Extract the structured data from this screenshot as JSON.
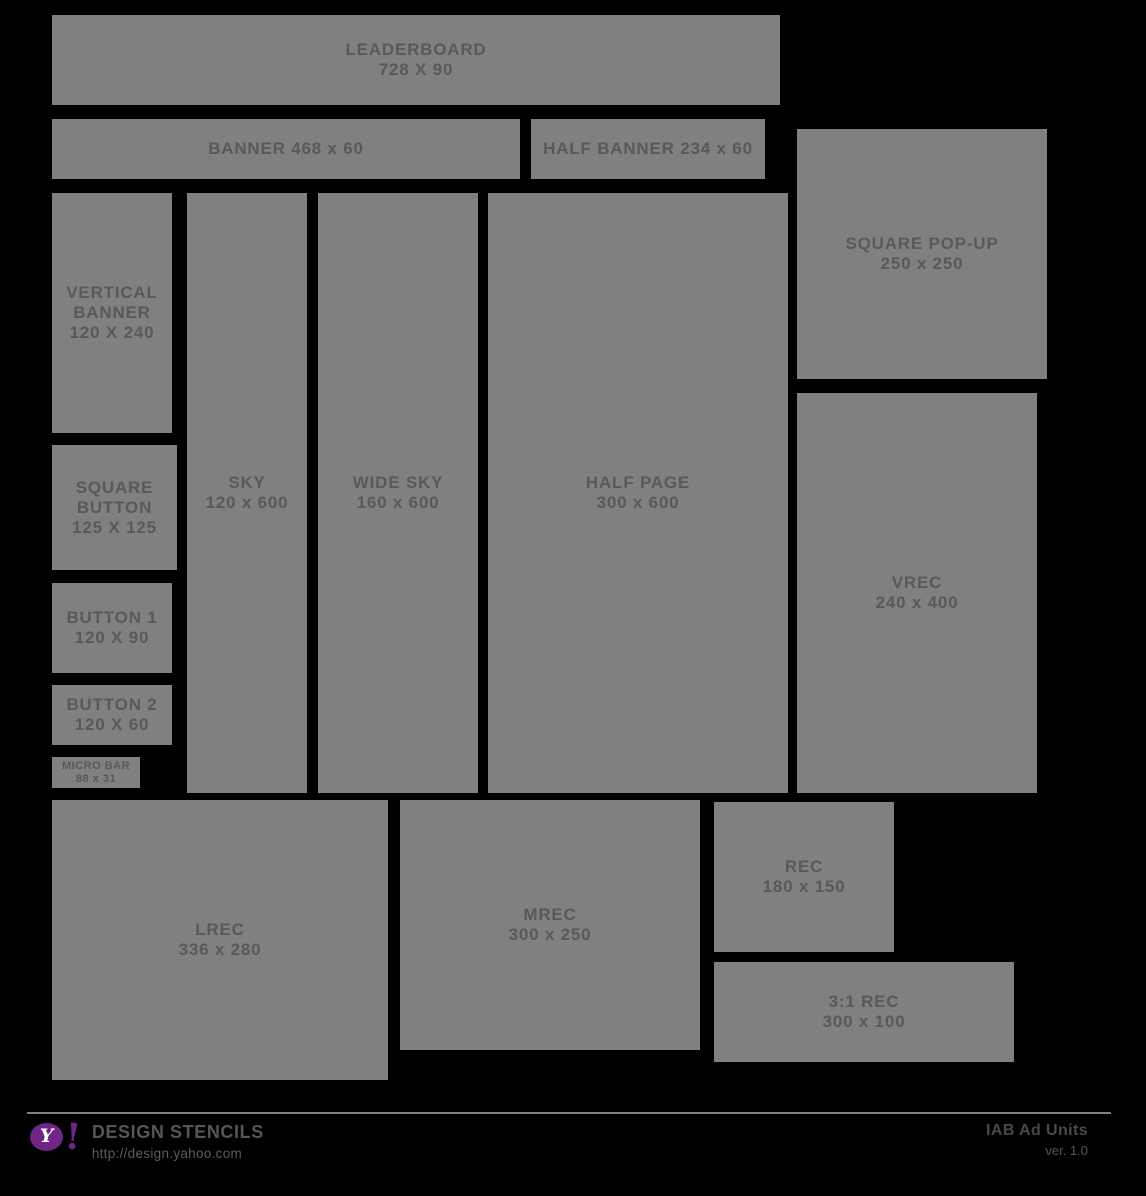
{
  "canvas": {
    "background": "#000000",
    "box_fill": "#808080",
    "box_text_color": "#58595b",
    "brand_purple": "#6e2585"
  },
  "ad_units": [
    {
      "id": "leaderboard",
      "lines": [
        "LEADERBOARD",
        "728 X 90"
      ],
      "x": 52,
      "y": 15,
      "w": 728,
      "h": 90,
      "small": false
    },
    {
      "id": "banner",
      "lines": [
        "BANNER 468 x 60"
      ],
      "x": 52,
      "y": 119,
      "w": 468,
      "h": 60,
      "small": false
    },
    {
      "id": "half-banner",
      "lines": [
        "HALF BANNER 234 x 60"
      ],
      "x": 531,
      "y": 119,
      "w": 234,
      "h": 60,
      "small": false
    },
    {
      "id": "vertical-banner",
      "lines": [
        "VERTICAL",
        "BANNER",
        "120 X 240"
      ],
      "x": 52,
      "y": 193,
      "w": 120,
      "h": 240,
      "small": false
    },
    {
      "id": "square-pop-up",
      "lines": [
        "SQUARE POP-UP",
        "250 x 250"
      ],
      "x": 797,
      "y": 129,
      "w": 250,
      "h": 250,
      "small": false
    },
    {
      "id": "sky",
      "lines": [
        "SKY",
        "120 x 600"
      ],
      "x": 187,
      "y": 193,
      "w": 120,
      "h": 600,
      "small": false
    },
    {
      "id": "wide-sky",
      "lines": [
        "WIDE SKY",
        "160 x 600"
      ],
      "x": 318,
      "y": 193,
      "w": 160,
      "h": 600,
      "small": false
    },
    {
      "id": "half-page",
      "lines": [
        "HALF PAGE",
        "300 x 600"
      ],
      "x": 488,
      "y": 193,
      "w": 300,
      "h": 600,
      "small": false
    },
    {
      "id": "vrec",
      "lines": [
        "VREC",
        "240 x 400"
      ],
      "x": 797,
      "y": 393,
      "w": 240,
      "h": 400,
      "small": false
    },
    {
      "id": "square-button",
      "lines": [
        "SQUARE",
        "BUTTON",
        "125 X 125"
      ],
      "x": 52,
      "y": 445,
      "w": 125,
      "h": 125,
      "small": false
    },
    {
      "id": "button-1",
      "lines": [
        "BUTTON 1",
        "120 X 90"
      ],
      "x": 52,
      "y": 583,
      "w": 120,
      "h": 90,
      "small": false
    },
    {
      "id": "button-2",
      "lines": [
        "BUTTON 2",
        "120 X 60"
      ],
      "x": 52,
      "y": 685,
      "w": 120,
      "h": 60,
      "small": false
    },
    {
      "id": "micro-bar",
      "lines": [
        "MICRO BAR",
        "88 x 31"
      ],
      "x": 52,
      "y": 757,
      "w": 88,
      "h": 31,
      "small": true
    },
    {
      "id": "lrec",
      "lines": [
        "LREC",
        "336 x 280"
      ],
      "x": 52,
      "y": 800,
      "w": 336,
      "h": 280,
      "small": false
    },
    {
      "id": "mrec",
      "lines": [
        "MREC",
        "300 x 250"
      ],
      "x": 400,
      "y": 800,
      "w": 300,
      "h": 250,
      "small": false
    },
    {
      "id": "rec",
      "lines": [
        "REC",
        "180 x 150"
      ],
      "x": 714,
      "y": 802,
      "w": 180,
      "h": 150,
      "small": false
    },
    {
      "id": "rec-3-1",
      "lines": [
        "3:1 REC",
        "300 x 100"
      ],
      "x": 714,
      "y": 962,
      "w": 300,
      "h": 100,
      "small": false
    }
  ],
  "footer": {
    "logo": {
      "y_letter": "Y",
      "exclamation": "!"
    },
    "brand_title": "DESIGN STENCILS",
    "brand_url": "http://design.yahoo.com",
    "doc_title": "IAB Ad Units",
    "doc_version": "ver. 1.0"
  }
}
